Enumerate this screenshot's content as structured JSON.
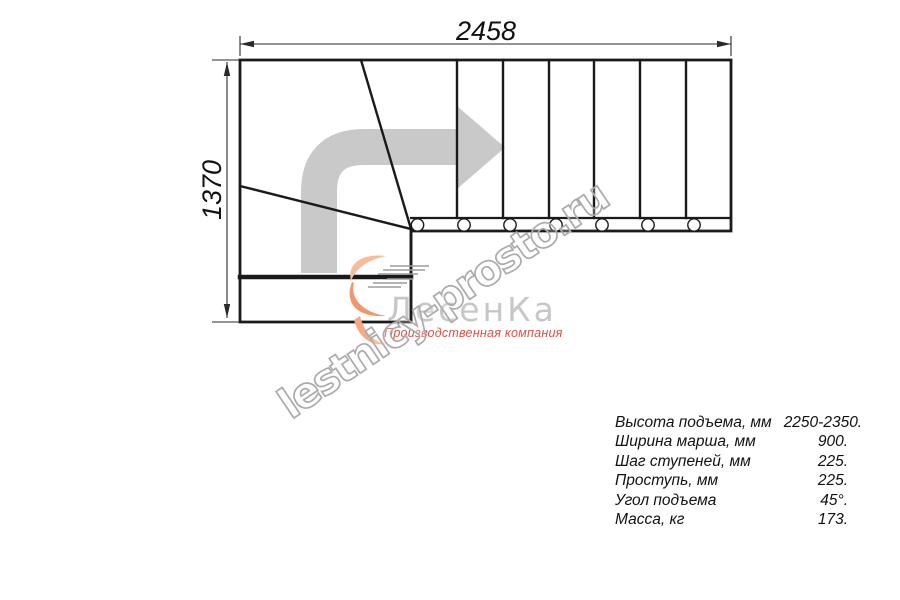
{
  "drawing": {
    "title": "stair-plan-top-view",
    "width_label": "2458",
    "height_label": "1370"
  },
  "watermark": {
    "text": "lestnicy-prosto.ru"
  },
  "logo": {
    "name": "ЛесенКа",
    "tagline": "Производственная компания"
  },
  "specs": {
    "rows": [
      {
        "label": "Высота подъема, мм",
        "value": "2250-2350."
      },
      {
        "label": "Ширина марша, мм",
        "value": "900."
      },
      {
        "label": "Шаг ступеней, мм",
        "value": "225."
      },
      {
        "label": "Проступь, мм",
        "value": "225."
      },
      {
        "label": "Угол подъема",
        "value": "45°."
      },
      {
        "label": "Масса, кг",
        "value": "173."
      }
    ]
  },
  "colors": {
    "line": "#1a1a1a",
    "dim_line": "#2a2a2a",
    "arrow_gray": "#c9c9c9",
    "watermark_stroke": "#ababab",
    "logo_gray": "#c7c7c7",
    "logo_red": "#dc5245",
    "swoosh_light": "#f7bd9a",
    "swoosh_mid": "#f0976d",
    "swoosh_tail": "#f4ab84",
    "speed_lines": "#9b9b9b"
  }
}
